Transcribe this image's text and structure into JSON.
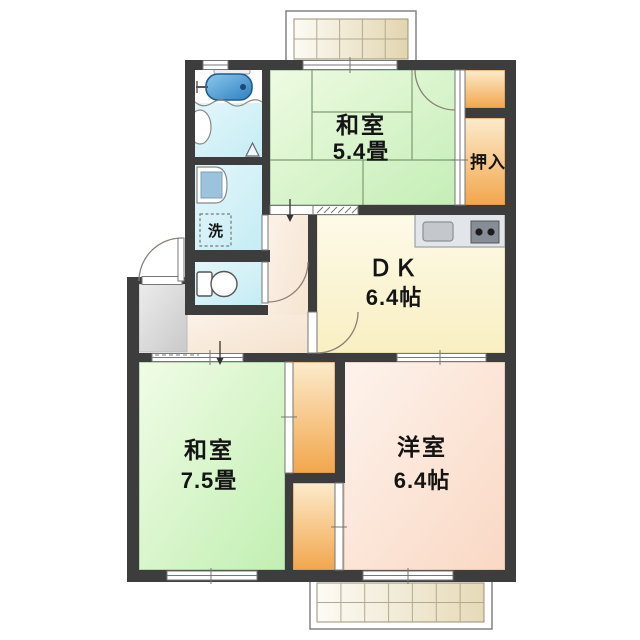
{
  "floorplan": {
    "rooms": {
      "washitsu_upper": {
        "name": "和室",
        "size": "5.4畳"
      },
      "oshiire": {
        "name": "押入"
      },
      "dk": {
        "name": "ＤＫ",
        "size": "6.4帖"
      },
      "washitsu_lower": {
        "name": "和室",
        "size": "7.5畳"
      },
      "youshitsu": {
        "name": "洋室",
        "size": "6.4帖"
      },
      "laundry": {
        "name": "洗"
      }
    },
    "colors": {
      "wall": "#3d3d3d",
      "washitsu_green": "#d9f3cc",
      "youshitsu_peach": "#fce4d6",
      "dk_cream": "#fbf3cf",
      "closet_orange": "#f4ac54",
      "bath_cyan": "#d9f2f8",
      "hall_beige": "#f8ebdc",
      "genkan_gray": "#d9d9d9",
      "balcony_tile": "#ece1c2",
      "bathtub_blue": "#3f93cf"
    }
  }
}
